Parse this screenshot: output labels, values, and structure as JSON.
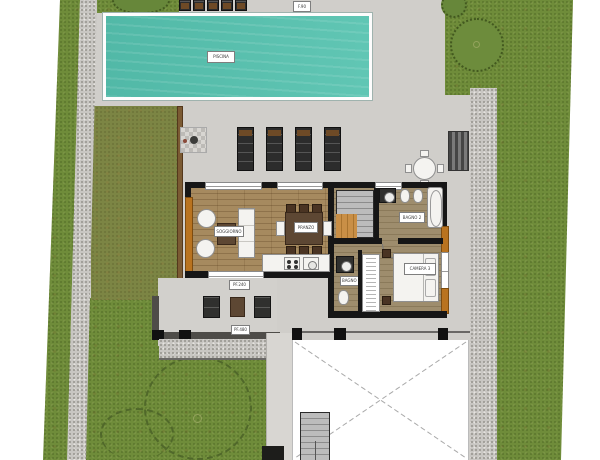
{
  "plan": {
    "title": "Villa site plan with pool, garden and garage court",
    "labels": {
      "pool": "PISCINA",
      "top_window_tag": "F.90",
      "living": "SOGGIORNO",
      "dining": "PRANZO",
      "bath_main": "BAGNO 2",
      "bath_small": "BAGNO",
      "bedroom": "CAMERA 3",
      "patio_tag_top": "PF.240",
      "patio_tag_bottom": "PF.480"
    },
    "colors": {
      "grass": "#6f8c3a",
      "grass_olive": "#7c8544",
      "pool_water": "#58c3b0",
      "deck_concrete": "#d2d0cc",
      "gravel": "#c8c6c2",
      "wall": "#161616",
      "wood_floor": "#a68a5f",
      "wood_frame_accent": "#b9731f",
      "furniture_dark": "#30302e",
      "furniture_brown": "#5d4733",
      "garage_void": "#ffffff"
    },
    "features": [
      "swimming-pool",
      "sun-loungers",
      "outdoor-dining-table",
      "living-room",
      "dining-room",
      "kitchen",
      "staircase",
      "bathroom-with-tub",
      "bedroom",
      "wardrobe",
      "covered-patio",
      "garage-court",
      "gravel-paths",
      "lawns",
      "trees"
    ]
  }
}
